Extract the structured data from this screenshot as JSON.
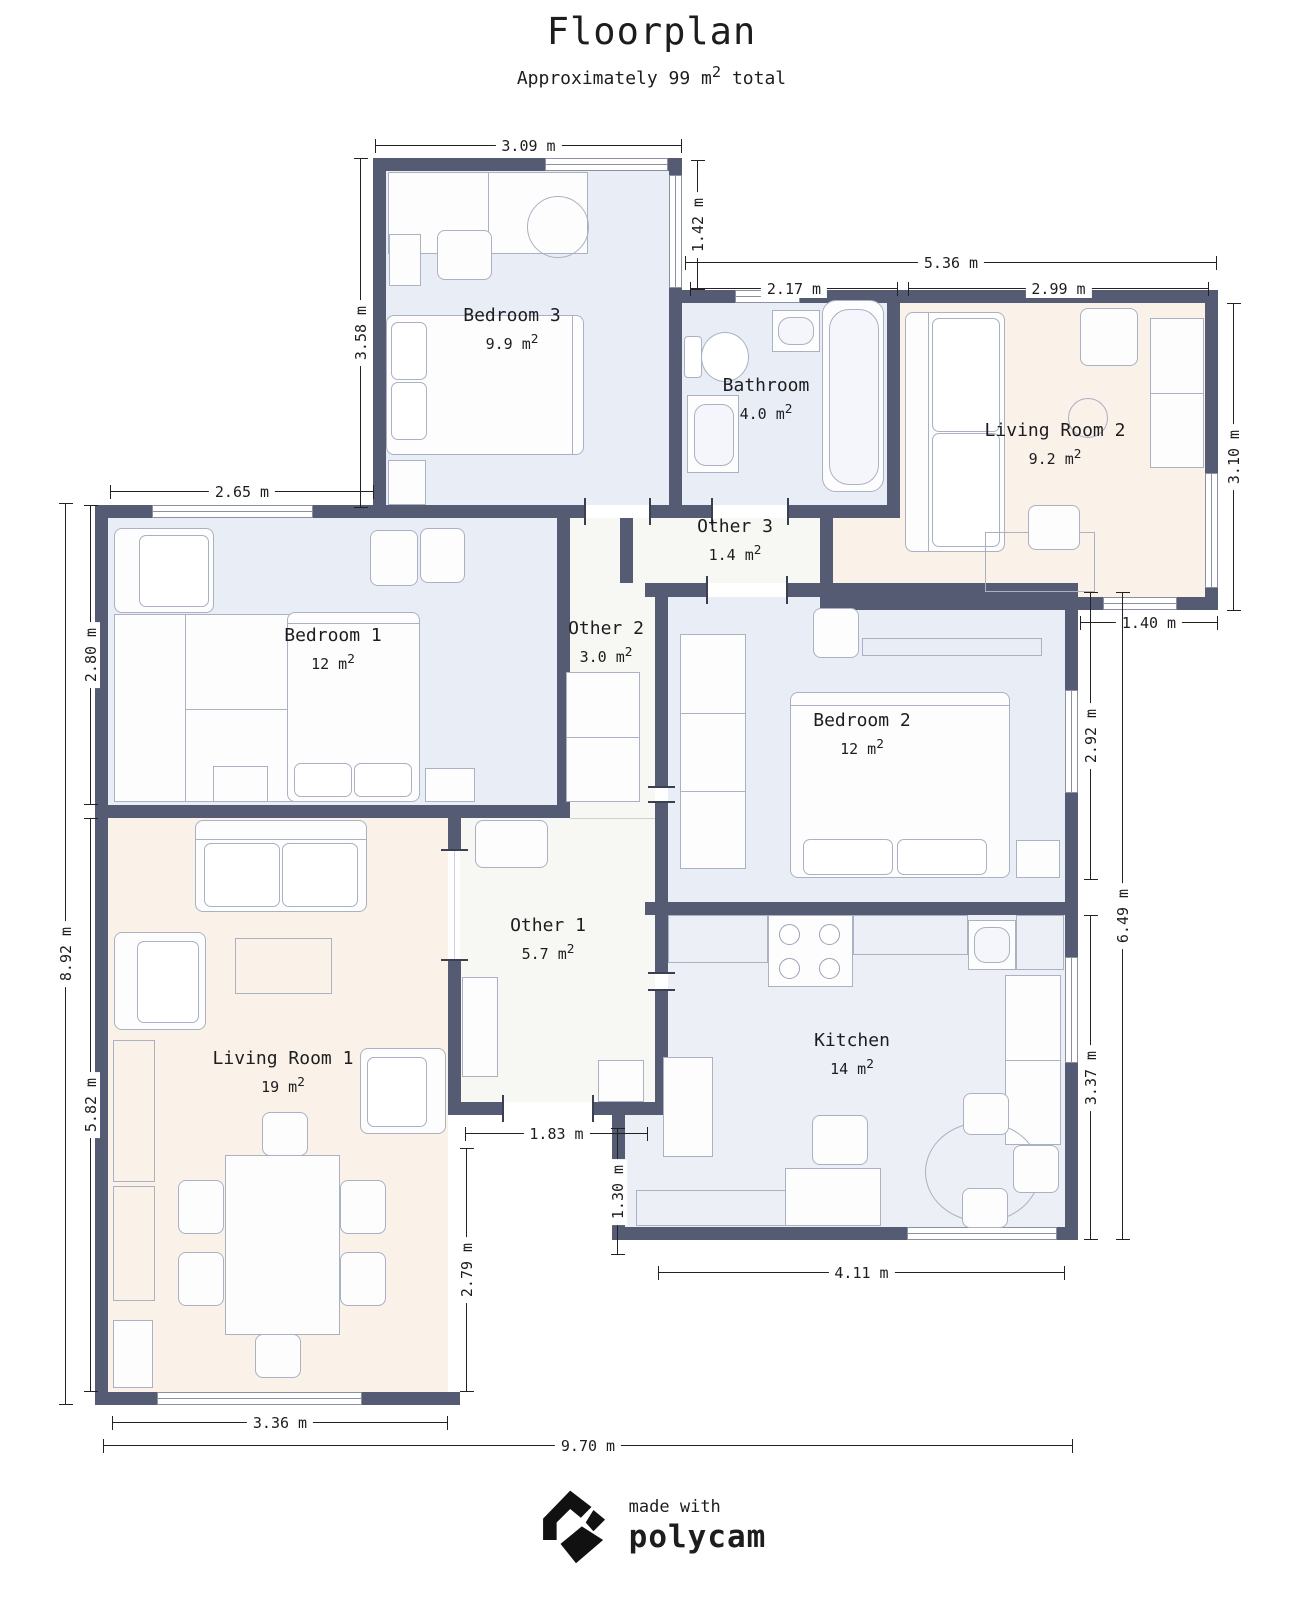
{
  "header": {
    "title": "Floorplan",
    "subtitle_prefix": "Approximately 99 m",
    "subtitle_sup": "2",
    "subtitle_suffix": " total"
  },
  "rooms": [
    {
      "name": "Bedroom 3",
      "area": "9.9 m",
      "area_sup": "2"
    },
    {
      "name": "Bathroom",
      "area": "4.0 m",
      "area_sup": "2"
    },
    {
      "name": "Living Room 2",
      "area": "9.2 m",
      "area_sup": "2"
    },
    {
      "name": "Other 3",
      "area": "1.4 m",
      "area_sup": "2"
    },
    {
      "name": "Bedroom 1",
      "area": "12 m",
      "area_sup": "2"
    },
    {
      "name": "Other 2",
      "area": "3.0 m",
      "area_sup": "2"
    },
    {
      "name": "Bedroom 2",
      "area": "12 m",
      "area_sup": "2"
    },
    {
      "name": "Other 1",
      "area": "5.7 m",
      "area_sup": "2"
    },
    {
      "name": "Kitchen",
      "area": "14 m",
      "area_sup": "2"
    },
    {
      "name": "Living Room 1",
      "area": "19 m",
      "area_sup": "2"
    }
  ],
  "dimensions": [
    {
      "label": "3.09 m"
    },
    {
      "label": "1.42 m"
    },
    {
      "label": "5.36 m"
    },
    {
      "label": "2.17 m"
    },
    {
      "label": "2.99 m"
    },
    {
      "label": "3.58 m"
    },
    {
      "label": "3.10 m"
    },
    {
      "label": "2.65 m"
    },
    {
      "label": "1.40 m"
    },
    {
      "label": "2.80 m"
    },
    {
      "label": "2.92 m"
    },
    {
      "label": "8.92 m"
    },
    {
      "label": "6.49 m"
    },
    {
      "label": "5.82 m"
    },
    {
      "label": "3.37 m"
    },
    {
      "label": "1.83 m"
    },
    {
      "label": "1.30 m"
    },
    {
      "label": "2.79 m"
    },
    {
      "label": "4.11 m"
    },
    {
      "label": "3.36 m"
    },
    {
      "label": "9.70 m"
    }
  ],
  "footer": {
    "made_with": "made with",
    "brand": "polycam"
  },
  "colors": {
    "wall": "#545b72",
    "bedroom_fill": "#e9edf6",
    "living_fill": "#faf1e9",
    "other_fill": "#f7f7f4",
    "kitchen_fill": "#edeff7",
    "dimension_line": "#222222",
    "logo": "#111111"
  }
}
